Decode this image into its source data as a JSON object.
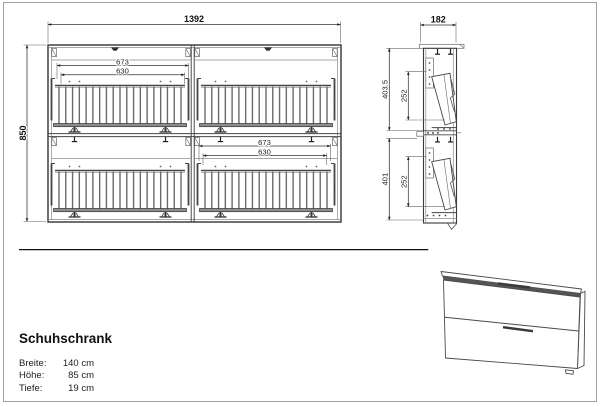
{
  "drawing": {
    "front_view": {
      "width": "1392",
      "height": "850",
      "top_basket_outer": "673",
      "top_basket_inner": "630",
      "bottom_basket_outer": "673",
      "bottom_basket_inner": "630"
    },
    "side_view": {
      "depth": "182",
      "upper_section_height": "403.5",
      "upper_opening": "252",
      "lower_section_height": "401",
      "lower_opening": "252"
    }
  },
  "title_block": {
    "product_name": "Schuhschrank",
    "specs": [
      {
        "label": "Breite:",
        "value": "140 cm"
      },
      {
        "label": "Höhe:",
        "value": "85 cm"
      },
      {
        "label": "Tiefe:",
        "value": "19 cm"
      }
    ]
  },
  "colors": {
    "line": "#3a3a3a",
    "dim_text": "#1d1d1d",
    "frame": "#a0a0a0",
    "background": "#ffffff"
  }
}
